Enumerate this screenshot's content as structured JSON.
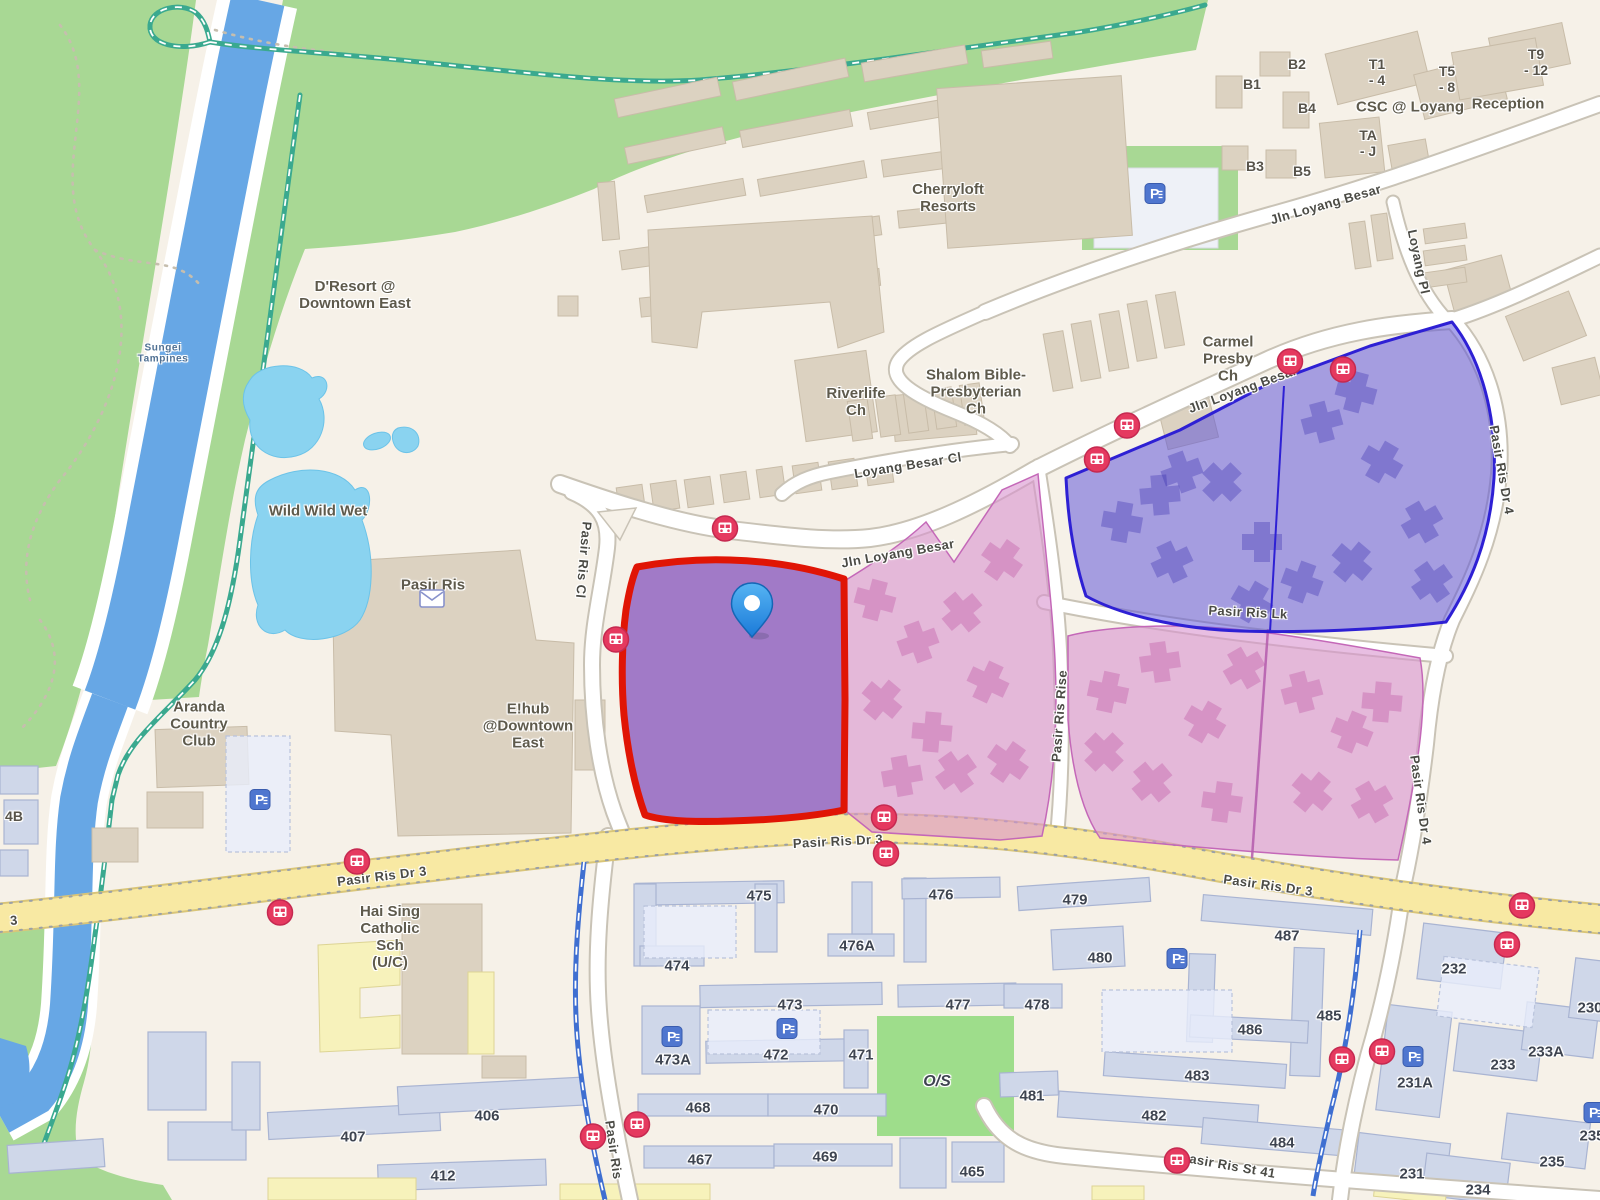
{
  "labels": {
    "pois": [
      {
        "text": "Cherryloft\nResorts",
        "x": 948,
        "y": 199
      },
      {
        "text": "D'Resort @\nDowntown East",
        "x": 355,
        "y": 296
      },
      {
        "text": "Wild Wild Wet",
        "x": 318,
        "y": 512
      },
      {
        "text": "Pasir Ris",
        "x": 433,
        "y": 586
      },
      {
        "text": "Aranda\nCountry\nClub",
        "x": 199,
        "y": 725
      },
      {
        "text": "E!hub\n@Downtown\nEast",
        "x": 528,
        "y": 727
      },
      {
        "text": "Hai Sing\nCatholic\nSch\n(U/C)",
        "x": 390,
        "y": 938
      },
      {
        "text": "Riverlife\nCh",
        "x": 856,
        "y": 403
      },
      {
        "text": "Shalom Bible-\nPresbyterian\nCh",
        "x": 976,
        "y": 393
      },
      {
        "text": "Carmel\nPresby\nCh",
        "x": 1228,
        "y": 360
      },
      {
        "text": "CSC @ Loyang",
        "x": 1410,
        "y": 108
      },
      {
        "text": "Reception",
        "x": 1508,
        "y": 105
      }
    ],
    "areas": [
      {
        "text": "T1\n- 4",
        "x": 1377,
        "y": 73
      },
      {
        "text": "T5\n- 8",
        "x": 1447,
        "y": 80
      },
      {
        "text": "T9\n- 12",
        "x": 1536,
        "y": 63
      },
      {
        "text": "TA\n- J",
        "x": 1368,
        "y": 144
      },
      {
        "text": "B1",
        "x": 1252,
        "y": 85
      },
      {
        "text": "B2",
        "x": 1297,
        "y": 65
      },
      {
        "text": "B3",
        "x": 1255,
        "y": 167
      },
      {
        "text": "B4",
        "x": 1307,
        "y": 109
      },
      {
        "text": "B5",
        "x": 1302,
        "y": 172
      },
      {
        "text": "4B",
        "x": 14,
        "y": 817
      }
    ],
    "water": [
      {
        "text": "Sungei\nTampines",
        "x": 163,
        "y": 354
      }
    ],
    "roads": [
      {
        "text": "Jln Loyang Besar",
        "x": 898,
        "y": 554,
        "rot": -10
      },
      {
        "text": "Jln Loyang Besar",
        "x": 1243,
        "y": 390,
        "rot": -20
      },
      {
        "text": "Jln Loyang Besar",
        "x": 1326,
        "y": 205,
        "rot": -16
      },
      {
        "text": "Loyang Besar Cl",
        "x": 908,
        "y": 466,
        "rot": -9
      },
      {
        "text": "Loyang Pl",
        "x": 1418,
        "y": 262,
        "rot": 78
      },
      {
        "text": "Pasir Ris Cl",
        "x": 583,
        "y": 560,
        "rot": 95
      },
      {
        "text": "Pasir Ris Rise",
        "x": 1060,
        "y": 716,
        "rot": -86
      },
      {
        "text": "Pasir Ris Lk",
        "x": 1248,
        "y": 613,
        "rot": 3
      },
      {
        "text": "Pasir Ris Dr 4",
        "x": 1501,
        "y": 470,
        "rot": 80
      },
      {
        "text": "Pasir Ris Dr 4",
        "x": 1420,
        "y": 800,
        "rot": 82
      },
      {
        "text": "Pasir Ris Dr 3",
        "x": 382,
        "y": 877,
        "rot": -7
      },
      {
        "text": "Pasir Ris Dr 3",
        "x": 838,
        "y": 842,
        "rot": -3
      },
      {
        "text": "Pasir Ris Dr 3",
        "x": 1268,
        "y": 886,
        "rot": 8
      },
      {
        "text": "Pasir Ris Dr 3",
        "x": 1627,
        "y": 940,
        "rot": 9
      },
      {
        "text": "3",
        "x": 14,
        "y": 921,
        "rot": -5
      },
      {
        "text": "Pasir Ris St 41",
        "x": 1228,
        "y": 1166,
        "rot": 10
      },
      {
        "text": "Pasir Ris",
        "x": 613,
        "y": 1150,
        "rot": 82
      }
    ],
    "blocks": [
      {
        "text": "406",
        "x": 487,
        "y": 1117
      },
      {
        "text": "407",
        "x": 353,
        "y": 1138
      },
      {
        "text": "412",
        "x": 443,
        "y": 1177
      },
      {
        "text": "474",
        "x": 677,
        "y": 967
      },
      {
        "text": "475",
        "x": 759,
        "y": 897
      },
      {
        "text": "476",
        "x": 941,
        "y": 896
      },
      {
        "text": "476A",
        "x": 857,
        "y": 947
      },
      {
        "text": "473",
        "x": 790,
        "y": 1006
      },
      {
        "text": "477",
        "x": 958,
        "y": 1006
      },
      {
        "text": "473A",
        "x": 673,
        "y": 1061
      },
      {
        "text": "472",
        "x": 776,
        "y": 1056
      },
      {
        "text": "471",
        "x": 861,
        "y": 1056
      },
      {
        "text": "468",
        "x": 698,
        "y": 1109
      },
      {
        "text": "470",
        "x": 826,
        "y": 1111
      },
      {
        "text": "467",
        "x": 700,
        "y": 1161
      },
      {
        "text": "469",
        "x": 825,
        "y": 1158
      },
      {
        "text": "465",
        "x": 972,
        "y": 1173
      },
      {
        "text": "O/S",
        "x": 937,
        "y": 1082,
        "it": 1,
        "fs": 16
      },
      {
        "text": "478",
        "x": 1037,
        "y": 1006
      },
      {
        "text": "479",
        "x": 1075,
        "y": 901
      },
      {
        "text": "480",
        "x": 1100,
        "y": 959
      },
      {
        "text": "481",
        "x": 1032,
        "y": 1097
      },
      {
        "text": "482",
        "x": 1154,
        "y": 1117
      },
      {
        "text": "483",
        "x": 1197,
        "y": 1077
      },
      {
        "text": "484",
        "x": 1282,
        "y": 1144
      },
      {
        "text": "485",
        "x": 1329,
        "y": 1017
      },
      {
        "text": "486",
        "x": 1250,
        "y": 1031
      },
      {
        "text": "487",
        "x": 1287,
        "y": 937
      },
      {
        "text": "231A",
        "x": 1415,
        "y": 1084
      },
      {
        "text": "232",
        "x": 1454,
        "y": 970
      },
      {
        "text": "233",
        "x": 1503,
        "y": 1066
      },
      {
        "text": "233A",
        "x": 1546,
        "y": 1053
      },
      {
        "text": "231",
        "x": 1412,
        "y": 1175
      },
      {
        "text": "234",
        "x": 1478,
        "y": 1191
      },
      {
        "text": "235",
        "x": 1552,
        "y": 1163
      },
      {
        "text": "235",
        "x": 1592,
        "y": 1137
      },
      {
        "text": "230",
        "x": 1590,
        "y": 1009
      }
    ]
  },
  "icons": {
    "bus_stops": [
      {
        "x": 725,
        "y": 531
      },
      {
        "x": 616,
        "y": 642
      },
      {
        "x": 884,
        "y": 820
      },
      {
        "x": 886,
        "y": 856
      },
      {
        "x": 357,
        "y": 864
      },
      {
        "x": 280,
        "y": 915
      },
      {
        "x": 1127,
        "y": 428
      },
      {
        "x": 1097,
        "y": 462
      },
      {
        "x": 1290,
        "y": 364
      },
      {
        "x": 1343,
        "y": 372
      },
      {
        "x": 1522,
        "y": 908
      },
      {
        "x": 1507,
        "y": 947
      },
      {
        "x": 593,
        "y": 1139
      },
      {
        "x": 637,
        "y": 1127
      },
      {
        "x": 1342,
        "y": 1062
      },
      {
        "x": 1382,
        "y": 1054
      },
      {
        "x": 1177,
        "y": 1163
      }
    ],
    "parking": [
      {
        "x": 1155,
        "y": 196
      },
      {
        "x": 260,
        "y": 802
      },
      {
        "x": 672,
        "y": 1039
      },
      {
        "x": 787,
        "y": 1031
      },
      {
        "x": 1177,
        "y": 961
      },
      {
        "x": 1413,
        "y": 1059
      },
      {
        "x": 1594,
        "y": 1115
      }
    ],
    "post_office": {
      "x": 432,
      "y": 601
    },
    "pin": {
      "x": 752,
      "y": 637
    }
  },
  "colors": {
    "selected_parcel_outline": "#e01505",
    "selected_parcel_fill": "#8e5fc0",
    "zone_blue": "#5b50d8",
    "zone_blue_outline": "#2e20d4",
    "zone_pink": "#d893cf",
    "road_major_fill": "#f8e9a3",
    "park_green": "#a8d894",
    "water_blue": "#67a7e5",
    "pool_blue": "#8ad3f0",
    "pin_blue": "#2e8fe0",
    "bus_icon": "#e5395f",
    "parking_icon": "#4f76cf"
  }
}
